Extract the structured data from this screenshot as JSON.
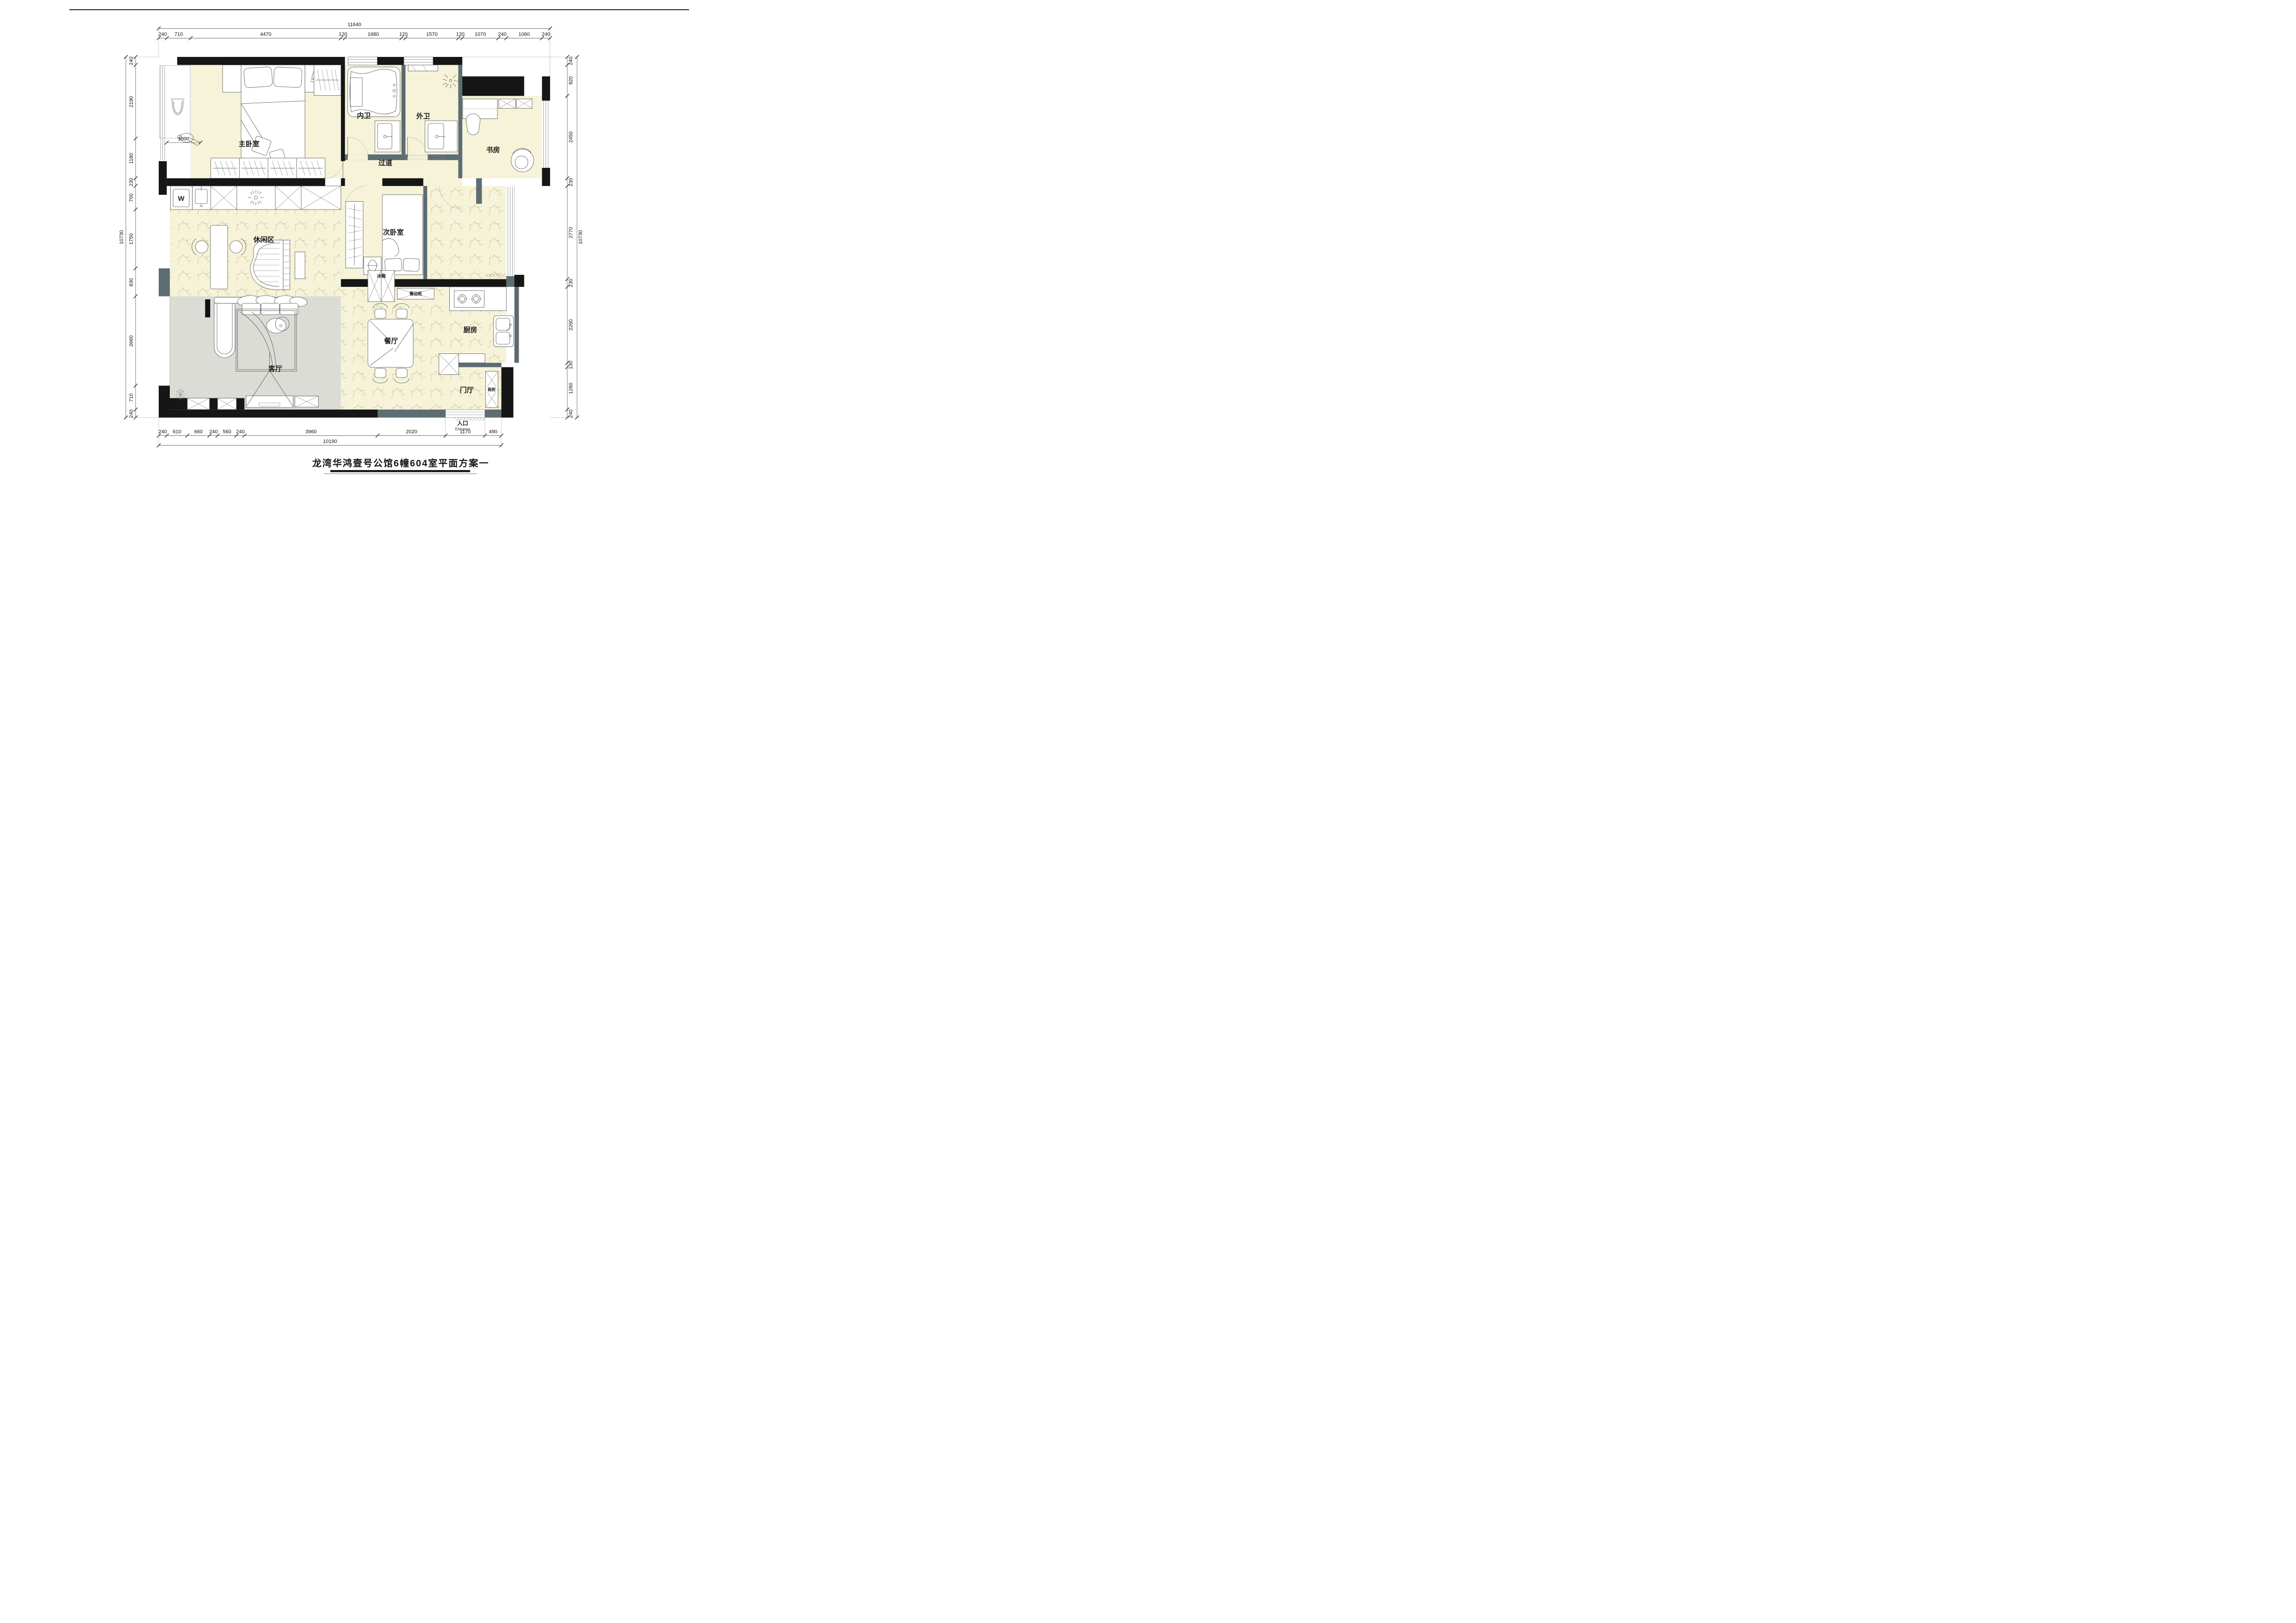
{
  "title": "龙湾华鸿壹号公馆6幢604室平面方案一",
  "rooms": {
    "master_bedroom": "主卧室",
    "inner_bath": "内卫",
    "outer_bath": "外卫",
    "study": "书房",
    "corridor": "过道",
    "leisure": "休闲区",
    "second_bedroom": "次卧室",
    "kitchen": "厨房",
    "dining": "餐厅",
    "living": "客厅",
    "foyer": "门厅"
  },
  "fixtures": {
    "fridge": "冰箱",
    "sideboard": "餐边柜",
    "shoe_cabinet": "鞋柜",
    "washer": "W"
  },
  "entrance": {
    "cn": "入口",
    "en": "Entrance"
  },
  "inner_dimension": "1000",
  "dimensions": {
    "top": {
      "total": "11640",
      "segments": [
        "240",
        "710",
        "4470",
        "120",
        "1680",
        "120",
        "1570",
        "120",
        "1070",
        "240",
        "1060",
        "240"
      ]
    },
    "left": {
      "total": "10730",
      "segments": [
        "240",
        "2190",
        "1180",
        "230",
        "700",
        "1750",
        "830",
        "2660",
        "710",
        "240"
      ]
    },
    "right": {
      "total": "10730",
      "segments": [
        "240",
        "920",
        "2450",
        "230",
        "2770",
        "230",
        "2260",
        "130",
        "1260",
        "240"
      ]
    },
    "bottom": {
      "total": "10190",
      "segments": [
        "240",
        "610",
        "660",
        "240",
        "560",
        "240",
        "3960",
        "2020",
        "1170",
        "490"
      ]
    }
  },
  "colors": {
    "floor_yellow": "#f6f3d9",
    "floor_gray": "#dcdcd6",
    "wall_black": "#161616",
    "wall_slate": "#5d6d74",
    "marble_line": "#b3ad86"
  }
}
